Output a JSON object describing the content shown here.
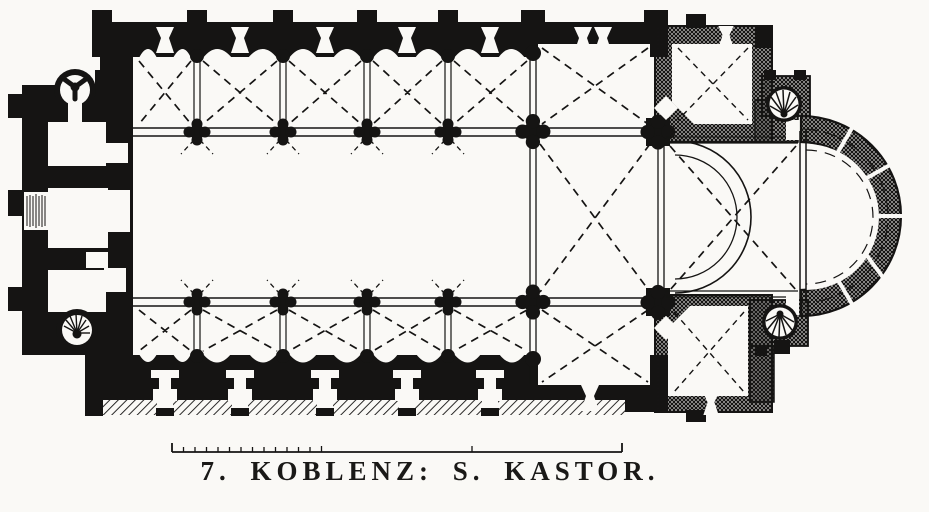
{
  "figure": {
    "number": "7.",
    "title": "KOBLENZ: S. KASTOR.",
    "caption": "7. KOBLENZ: S. KASTOR.",
    "kind": "engraved church ground plan"
  },
  "colors": {
    "paper": "#faf9f6",
    "ink": "#151413"
  },
  "scale_bar": {
    "present": true,
    "ticks": 14
  },
  "plan_elements": [
    "westwork-block",
    "northwest-stair-turret",
    "southwest-stair-turret",
    "west-entrance-steps",
    "nave",
    "north-aisle-vaulted-bays",
    "south-aisle-vaulted-bays",
    "arcade-quatrefoil-piers",
    "crossing",
    "inscribed-transept-arms",
    "choir-bay",
    "semicircular-apse",
    "northeast-chapel",
    "southeast-chapel",
    "northeast-stair-turret",
    "southeast-stair-turret",
    "wall-niches",
    "buttresses",
    "south-porch-hatched-wall",
    "scale-bar"
  ]
}
